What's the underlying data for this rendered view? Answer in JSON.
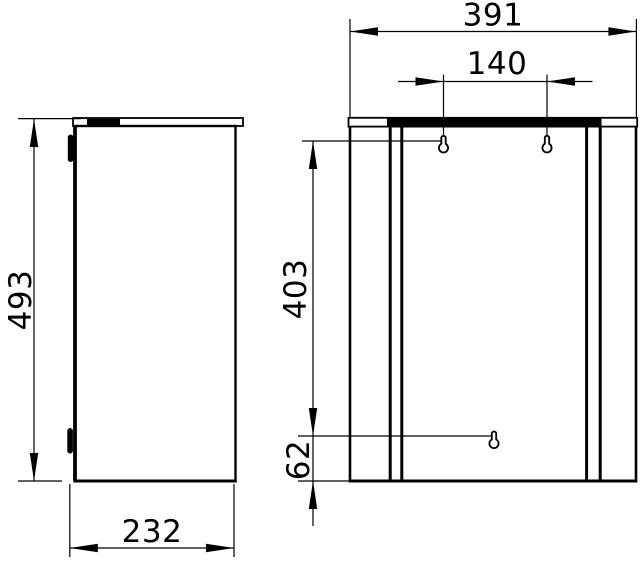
{
  "drawing": {
    "type": "technical-dimension-drawing",
    "background": "#ffffff",
    "line_color": "#000000",
    "views": {
      "side": {
        "name": "side-view",
        "dims": {
          "height": "493",
          "depth": "232"
        }
      },
      "front": {
        "name": "front-view",
        "dims": {
          "width": "391",
          "hole_spacing": "140",
          "hole_vertical_distance": "403",
          "bottom_hole_offset": "62"
        }
      }
    }
  }
}
